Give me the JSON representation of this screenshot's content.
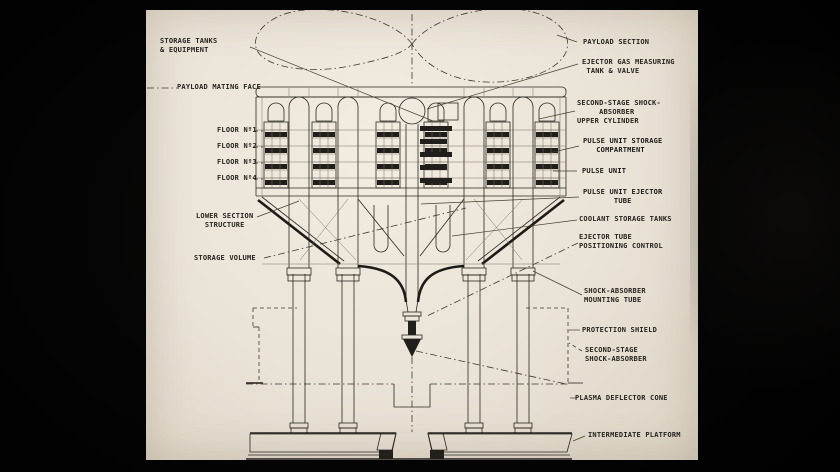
{
  "diagram": {
    "colors": {
      "background": "#000000",
      "paper": "#eae3d7",
      "ink": "#26241f"
    },
    "labels_left": [
      {
        "id": "storage-tanks-equipment",
        "text": "STORAGE TANKS\n& EQUIPMENT"
      },
      {
        "id": "payload-mating-face",
        "text": "PAYLOAD MATING FACE"
      },
      {
        "id": "floor-1",
        "text": "FLOOR Nº1"
      },
      {
        "id": "floor-2",
        "text": "FLOOR Nº2"
      },
      {
        "id": "floor-3",
        "text": "FLOOR Nº3"
      },
      {
        "id": "floor-4",
        "text": "FLOOR Nº4"
      },
      {
        "id": "lower-section-structure",
        "text": "LOWER SECTION\n  STRUCTURE"
      },
      {
        "id": "storage-volume",
        "text": "STORAGE VOLUME"
      }
    ],
    "labels_right": [
      {
        "id": "payload-section",
        "text": "PAYLOAD SECTION"
      },
      {
        "id": "ejector-gas-measuring",
        "text": "EJECTOR GAS MEASURING\n TANK & VALVE"
      },
      {
        "id": "second-stage-shock-upper",
        "text": "SECOND-STAGE SHOCK-\n     ABSORBER\nUPPER CYLINDER"
      },
      {
        "id": "pulse-unit-storage",
        "text": "PULSE UNIT STORAGE\n   COMPARTMENT"
      },
      {
        "id": "pulse-unit",
        "text": "PULSE UNIT"
      },
      {
        "id": "pulse-unit-ejector-tube",
        "text": "PULSE UNIT EJECTOR\n       TUBE"
      },
      {
        "id": "coolant-storage-tanks",
        "text": "COOLANT STORAGE TANKS"
      },
      {
        "id": "ejector-tube-positioning",
        "text": "EJECTOR TUBE\nPOSITIONING CONTROL"
      },
      {
        "id": "shock-absorber-mounting",
        "text": "SHOCK-ABSORBER\nMOUNTING TUBE"
      },
      {
        "id": "protection-shield",
        "text": "PROTECTION SHIELD"
      },
      {
        "id": "second-stage-shock-absorber",
        "text": "SECOND-STAGE\nSHOCK-ABSORBER"
      },
      {
        "id": "plasma-deflector-cone",
        "text": "PLASMA DEFLECTOR CONE"
      },
      {
        "id": "intermediate-platform",
        "text": "INTERMEDIATE PLATFORM"
      }
    ]
  }
}
